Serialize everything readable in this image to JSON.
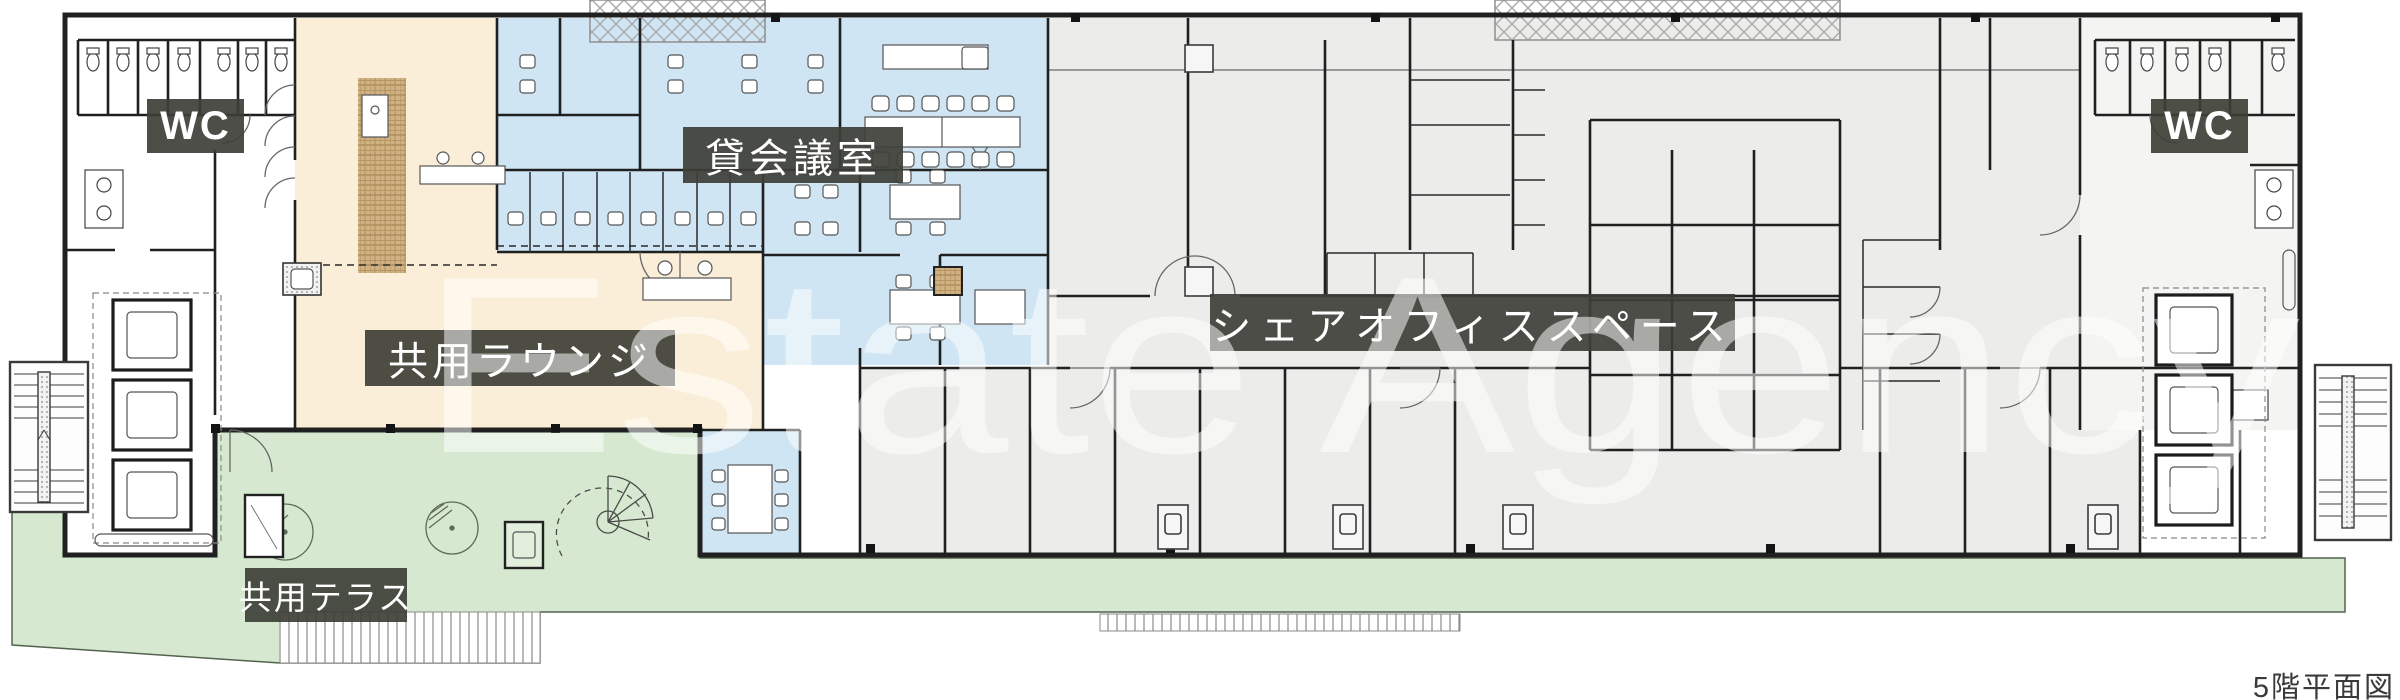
{
  "plan": {
    "watermark": "Estate Agency",
    "caption": "5階平面図",
    "areas": {
      "wc_left": "WC",
      "wc_right": "WC",
      "rental_meeting_room": "貸会議室",
      "shared_lounge": "共用ラウンジ",
      "share_office_space": "シェアオフィススペース",
      "shared_terrace": "共用テラス"
    },
    "colors": {
      "meeting_blue": "#cfe5f3",
      "lounge_beige": "#faeed8",
      "office_gray": "#ececea",
      "terrace_green": "#d6e9d0",
      "wood_tan": "#cfb183",
      "badge_dark": "#3e3f37",
      "wall_dark": "#202020",
      "caption_gray": "#3a3a3a"
    }
  }
}
